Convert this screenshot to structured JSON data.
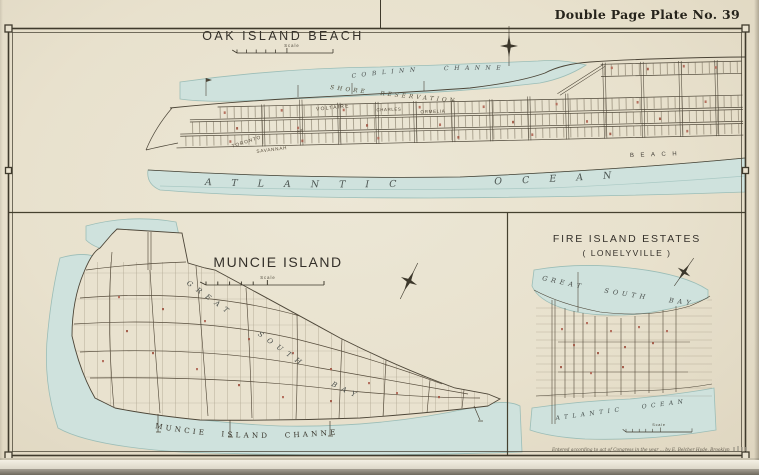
{
  "page": {
    "plate_label": "Double Page Plate No. 39",
    "credit": "Entered according to act of Congress in the year ... by E. Belcher Hyde, Brooklyn"
  },
  "colors": {
    "paper": "#e9e2cf",
    "water": "#cfe2dd",
    "ink": "#4c4537",
    "building_red": "#b5705f",
    "border": "#3f3a2c"
  },
  "oak": {
    "title": "OAK ISLAND BEACH",
    "scale_label": "Scale",
    "channel_label": "COBLINN CHANNEL",
    "shore_label": "SHORE RESERVATION",
    "beach_label": "BEACH",
    "ocean_label": "ATLANTIC OCEAN",
    "streets": {
      "voltaire": "VOLTAIRE",
      "toronto": "TORONTO",
      "ave": "AVE.",
      "savannah": "SAVANNAH",
      "ormelia": "ORMELIA",
      "charles": "CHARLES"
    }
  },
  "muncie": {
    "title": "MUNCIE ISLAND",
    "scale_label": "Scale",
    "bay_label": "GREAT SOUTH BAY",
    "channel_label": "MUNCIE ISLAND CHANNEL"
  },
  "lonelyville": {
    "title": "FIRE ISLAND ESTATES",
    "subtitle": "( LONELYVILLE )",
    "scale_label": "Scale",
    "bay_label": "GREAT SOUTH BAY",
    "ocean_label": "ATLANTIC OCEAN"
  }
}
